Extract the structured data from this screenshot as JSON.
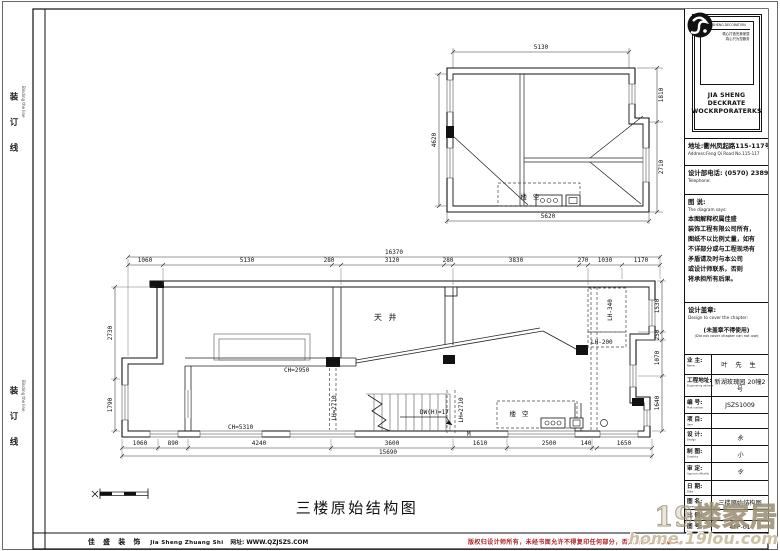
{
  "sheet": {
    "binding": {
      "cn": "装 订 线",
      "en": "Binding the line"
    },
    "footer": {
      "company_cn": "佳 盛 装 饰",
      "company_en": "Jia Sheng Zhuang Shi",
      "website": "网址: WWW.QZJSZS.COM",
      "copyright": "版权归设计师所有，未经书面允许不得复印任何部分，否则将承担一切后果。"
    },
    "watermark": {
      "text_cn": "19楼家居",
      "text_url": "home.19lou.com"
    }
  },
  "title_block": {
    "logo": {
      "mark_caption": "JIA SHENG DECORATION",
      "tagline1": "精心打造完美家居",
      "tagline2": "真心只为您服务",
      "company_line1": "JIA SHENG DECKRATE",
      "company_line2": "WOCKRPORATERKS"
    },
    "address_cn": "地址:衢州凤起路115-117号",
    "address_en": "Address:Feng Qi Road No.115-117",
    "phone_cn": "设计部电话: (0570) 2389348",
    "phone_en": "Telephone:",
    "note": {
      "label_cn": "图 说:",
      "label_en": "The diagram says:",
      "lines": [
        "本图解释权属佳盛",
        "装饰工程有限公司所有，",
        "图纸不以比例丈量，如有",
        "不详部分或与工程现场有",
        "矛盾请及时与本公司",
        "或设计师联系，否则",
        "将承担所有后果。"
      ]
    },
    "seal": {
      "label_cn": "设计盖章:",
      "label_en": "Design to cover the chapter:",
      "warn_cn": "(未盖章不得使用)",
      "warn_en": "(Did not cover chapter can not use)"
    },
    "rows": [
      {
        "label_cn": "业 主:",
        "label_en": "Name:",
        "value": "叶 先 生"
      },
      {
        "label_cn": "工程地址:",
        "label_en": "Engineering address",
        "value": "新湖玫瑰园 20幢2号"
      },
      {
        "label_cn": "编 号:",
        "label_en": "Plait number",
        "value": "JSZS1009"
      },
      {
        "label_cn": "项 目:",
        "label_en": "Item",
        "value": ""
      },
      {
        "label_cn": "设 计:",
        "label_en": "Design",
        "value": "永"
      },
      {
        "label_cn": "制 图:",
        "label_en": "Graphics",
        "value": "小"
      },
      {
        "label_cn": "审 定:",
        "label_en": "Approve officially",
        "value": "令"
      },
      {
        "label_cn": "日 期:",
        "label_en": "Date",
        "value": ""
      },
      {
        "label_cn": "图 名:",
        "label_en": "Drawing name",
        "value": "三楼原始结构图"
      },
      {
        "label_cn": "比 例:",
        "label_en": "Scale",
        "value": ""
      },
      {
        "label_cn": "图 号:",
        "label_en": "Diagram number",
        "value": "4FP-01"
      }
    ]
  },
  "drawing": {
    "title": "三楼原始结构图",
    "upper_plan": {
      "dims": {
        "top": "5130",
        "left": "4620",
        "right_top": "1810",
        "right_bottom": "2710",
        "bottom": "5620"
      },
      "labels": {
        "void": "楼 空"
      }
    },
    "main_plan": {
      "dims": {
        "overall_top": "16370",
        "top": [
          "1060",
          "5130",
          "280",
          "3120",
          "280",
          "3830",
          "270",
          "1030",
          "1170"
        ],
        "left": [
          "2730",
          "1790"
        ],
        "right": [
          "1530",
          "250",
          "1070",
          "1640"
        ],
        "bottom": [
          "1060",
          "890",
          "4240",
          "3600",
          "1610",
          "2500",
          "140",
          "1650"
        ],
        "overall_bottom": "15690"
      },
      "labels": {
        "courtyard": "天 井",
        "void": "楼 空",
        "ch_mid": "CH=2950",
        "ch_bottom": "CH=5310",
        "lh_mid": "LH=2710",
        "lh_right_1": "LH-340",
        "lh_right_2": "LH-200",
        "stair": "DW(H)=17",
        "door": "M"
      }
    }
  }
}
